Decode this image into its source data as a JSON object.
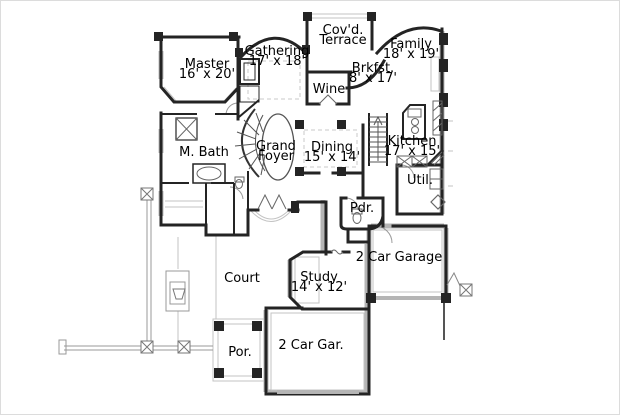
{
  "canvas": {
    "width": 620,
    "height": 415,
    "background": "#ffffff",
    "border_color": "#dcdcdc"
  },
  "palette": {
    "wall": "#242424",
    "poche": "#b5b5b5",
    "light_line": "#c3c3c3",
    "medium_line": "#8a8a8a",
    "fixture_line": "#666666",
    "fence_line": "#999999",
    "text": "#000000",
    "garage_door": "#b5b5b5"
  },
  "plan": {
    "type": "residential-floor-plan",
    "rooms": [
      {
        "id": "master",
        "line1": "Master",
        "line2": "16' x 20'"
      },
      {
        "id": "gathering",
        "line1": "Gathering",
        "line2": "17' x 18'"
      },
      {
        "id": "covd-terrace",
        "line1": "Cov'd.",
        "line2": "Terrace"
      },
      {
        "id": "family",
        "line1": "Family",
        "line2": "18' x 19'"
      },
      {
        "id": "brkfst",
        "line1": "Brkfst.",
        "line2": "8' x 17'"
      },
      {
        "id": "wine",
        "line1": "Wine",
        "line2": ""
      },
      {
        "id": "m-bath",
        "line1": "M. Bath",
        "line2": ""
      },
      {
        "id": "grand-foyer",
        "line1": "Grand",
        "line2": "Foyer"
      },
      {
        "id": "dining",
        "line1": "Dining",
        "line2": "15' x 14'"
      },
      {
        "id": "kitchen",
        "line1": "Kitchen",
        "line2": "17' x 15'"
      },
      {
        "id": "util",
        "line1": "Util.",
        "line2": ""
      },
      {
        "id": "pdr",
        "line1": "Pdr.",
        "line2": ""
      },
      {
        "id": "garage-2car",
        "line1": "2 Car Garage",
        "line2": ""
      },
      {
        "id": "court",
        "line1": "Court",
        "line2": ""
      },
      {
        "id": "study",
        "line1": "Study",
        "line2": "14' x 12'"
      },
      {
        "id": "gar-2car",
        "line1": "2 Car Gar.",
        "line2": ""
      },
      {
        "id": "porch",
        "line1": "Por.",
        "line2": ""
      }
    ]
  }
}
